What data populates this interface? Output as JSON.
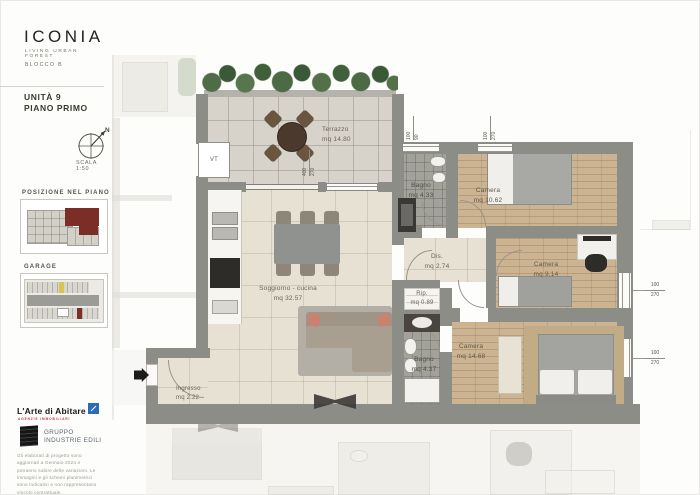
{
  "sidebar": {
    "brand": {
      "name": "ICONIA",
      "tagline": "LIVING URBAN FOREST",
      "block": "BLOCCO B"
    },
    "unit": {
      "title": "UNITÀ 9",
      "floor": "PIANO PRIMO"
    },
    "compass_label": "N",
    "scale": "SCALA 1:50",
    "position_section_title": "POSIZIONE NEL PIANO",
    "garage_section_title": "GARAGE",
    "partners": {
      "agency": "L'Arte di Abitare",
      "agency_tagline": "AGENZIE IMMOBILIARI",
      "group_line1": "GRUPPO",
      "group_line2": "INDUSTRIE EDILI"
    },
    "disclaimer": "Gli elaborati di progetto sono aggiornati a Gennaio 2024 e potranno subire delle variazioni. Le immagini e gli schemi planimetrici sono indicativi e non rappresentano vincolo contrattuale."
  },
  "plan": {
    "vt_label": "VT",
    "rooms": [
      {
        "id": "terrazzo",
        "name": "Terrazzo",
        "area": "mq 14.80"
      },
      {
        "id": "soggiorno",
        "name": "Soggiorno - cucina",
        "area": "mq 32.57"
      },
      {
        "id": "ingresso",
        "name": "Ingresso",
        "area": "mq 2.22"
      },
      {
        "id": "bagno1",
        "name": "Bagno",
        "area": "mq 4.33"
      },
      {
        "id": "camera1",
        "name": "Camera",
        "area": "mq 10.62"
      },
      {
        "id": "dis",
        "name": "Dis.",
        "area": "mq 2.74"
      },
      {
        "id": "camera2",
        "name": "Camera",
        "area": "mq 9.14"
      },
      {
        "id": "rip",
        "name": "Rip.",
        "area": "mq 0.89"
      },
      {
        "id": "bagno2",
        "name": "Bagno",
        "area": "mq 4.37"
      },
      {
        "id": "camera3",
        "name": "Camera",
        "area": "mq 14.68"
      }
    ],
    "dimensions": {
      "sliding_door": {
        "w": "400",
        "h": "270"
      },
      "window_bagno_top": {
        "w": "100",
        "h": "90"
      },
      "window_camera_top": {
        "w": "100",
        "h": "270"
      },
      "window_right_upper": {
        "w": "100",
        "h": "270"
      },
      "window_right_lower": {
        "w": "100",
        "h": "270"
      }
    }
  },
  "colors": {
    "accent_red": "#7b2d26",
    "hedge_green": "#46603f",
    "wall_grey": "#8d8d87",
    "wood_floor": "#ccb492",
    "bath_tile": "#a2a19a",
    "interior_tile": "#e7e1d3",
    "terrace_tile": "#d7d3ca",
    "sofa_pillow_salmon": "#cc8474",
    "garage_highlight_yellow": "#d6c64e",
    "brand_blue": "#2b6cb8",
    "brand_red": "#c03a2e"
  }
}
